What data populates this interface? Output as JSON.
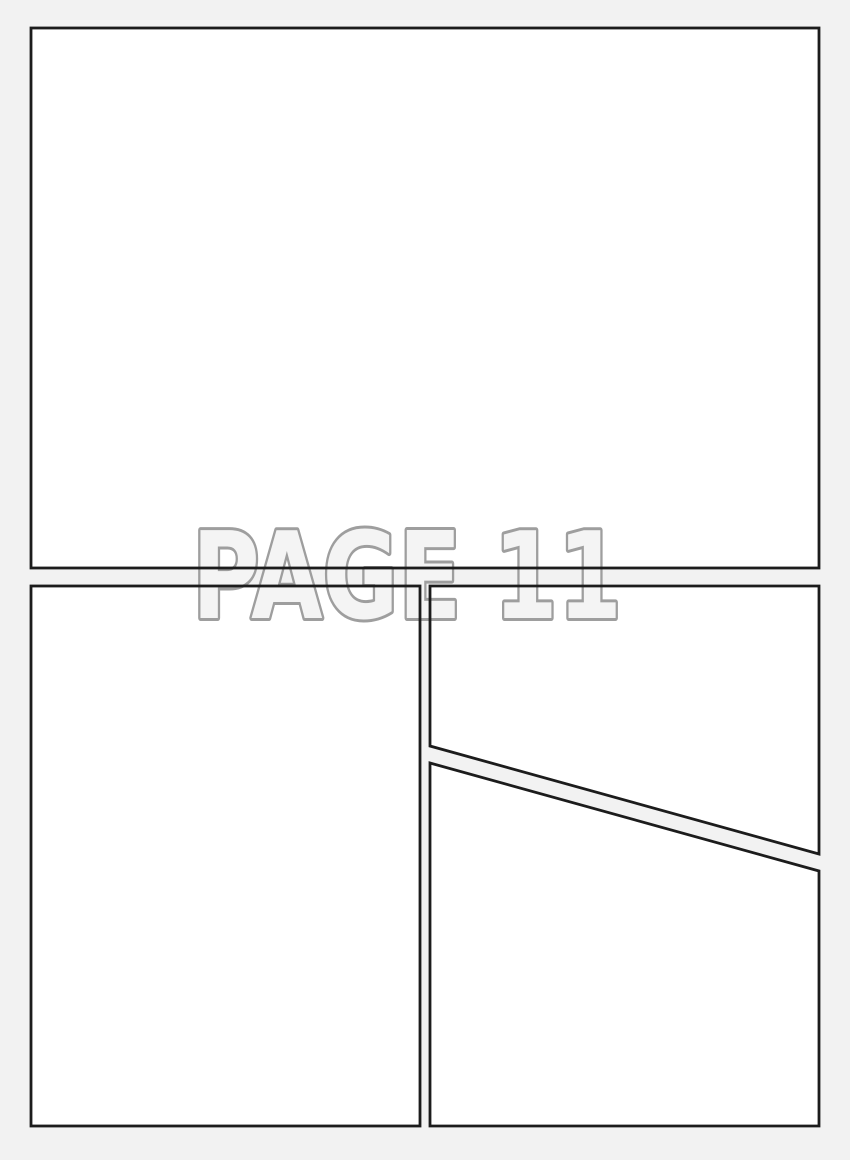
{
  "page": {
    "label": "PAGE 11"
  },
  "panels": {
    "count": 4,
    "names": [
      "top-panel",
      "bottom-left-panel",
      "bottom-right-upper-panel",
      "bottom-right-lower-panel"
    ]
  },
  "colors": {
    "page_background": "#f2f2f2",
    "panel_fill": "#ffffff",
    "panel_border": "#1c1c1c",
    "label_fill": "#f4f4f4",
    "label_outline": "#9e9e9e"
  }
}
